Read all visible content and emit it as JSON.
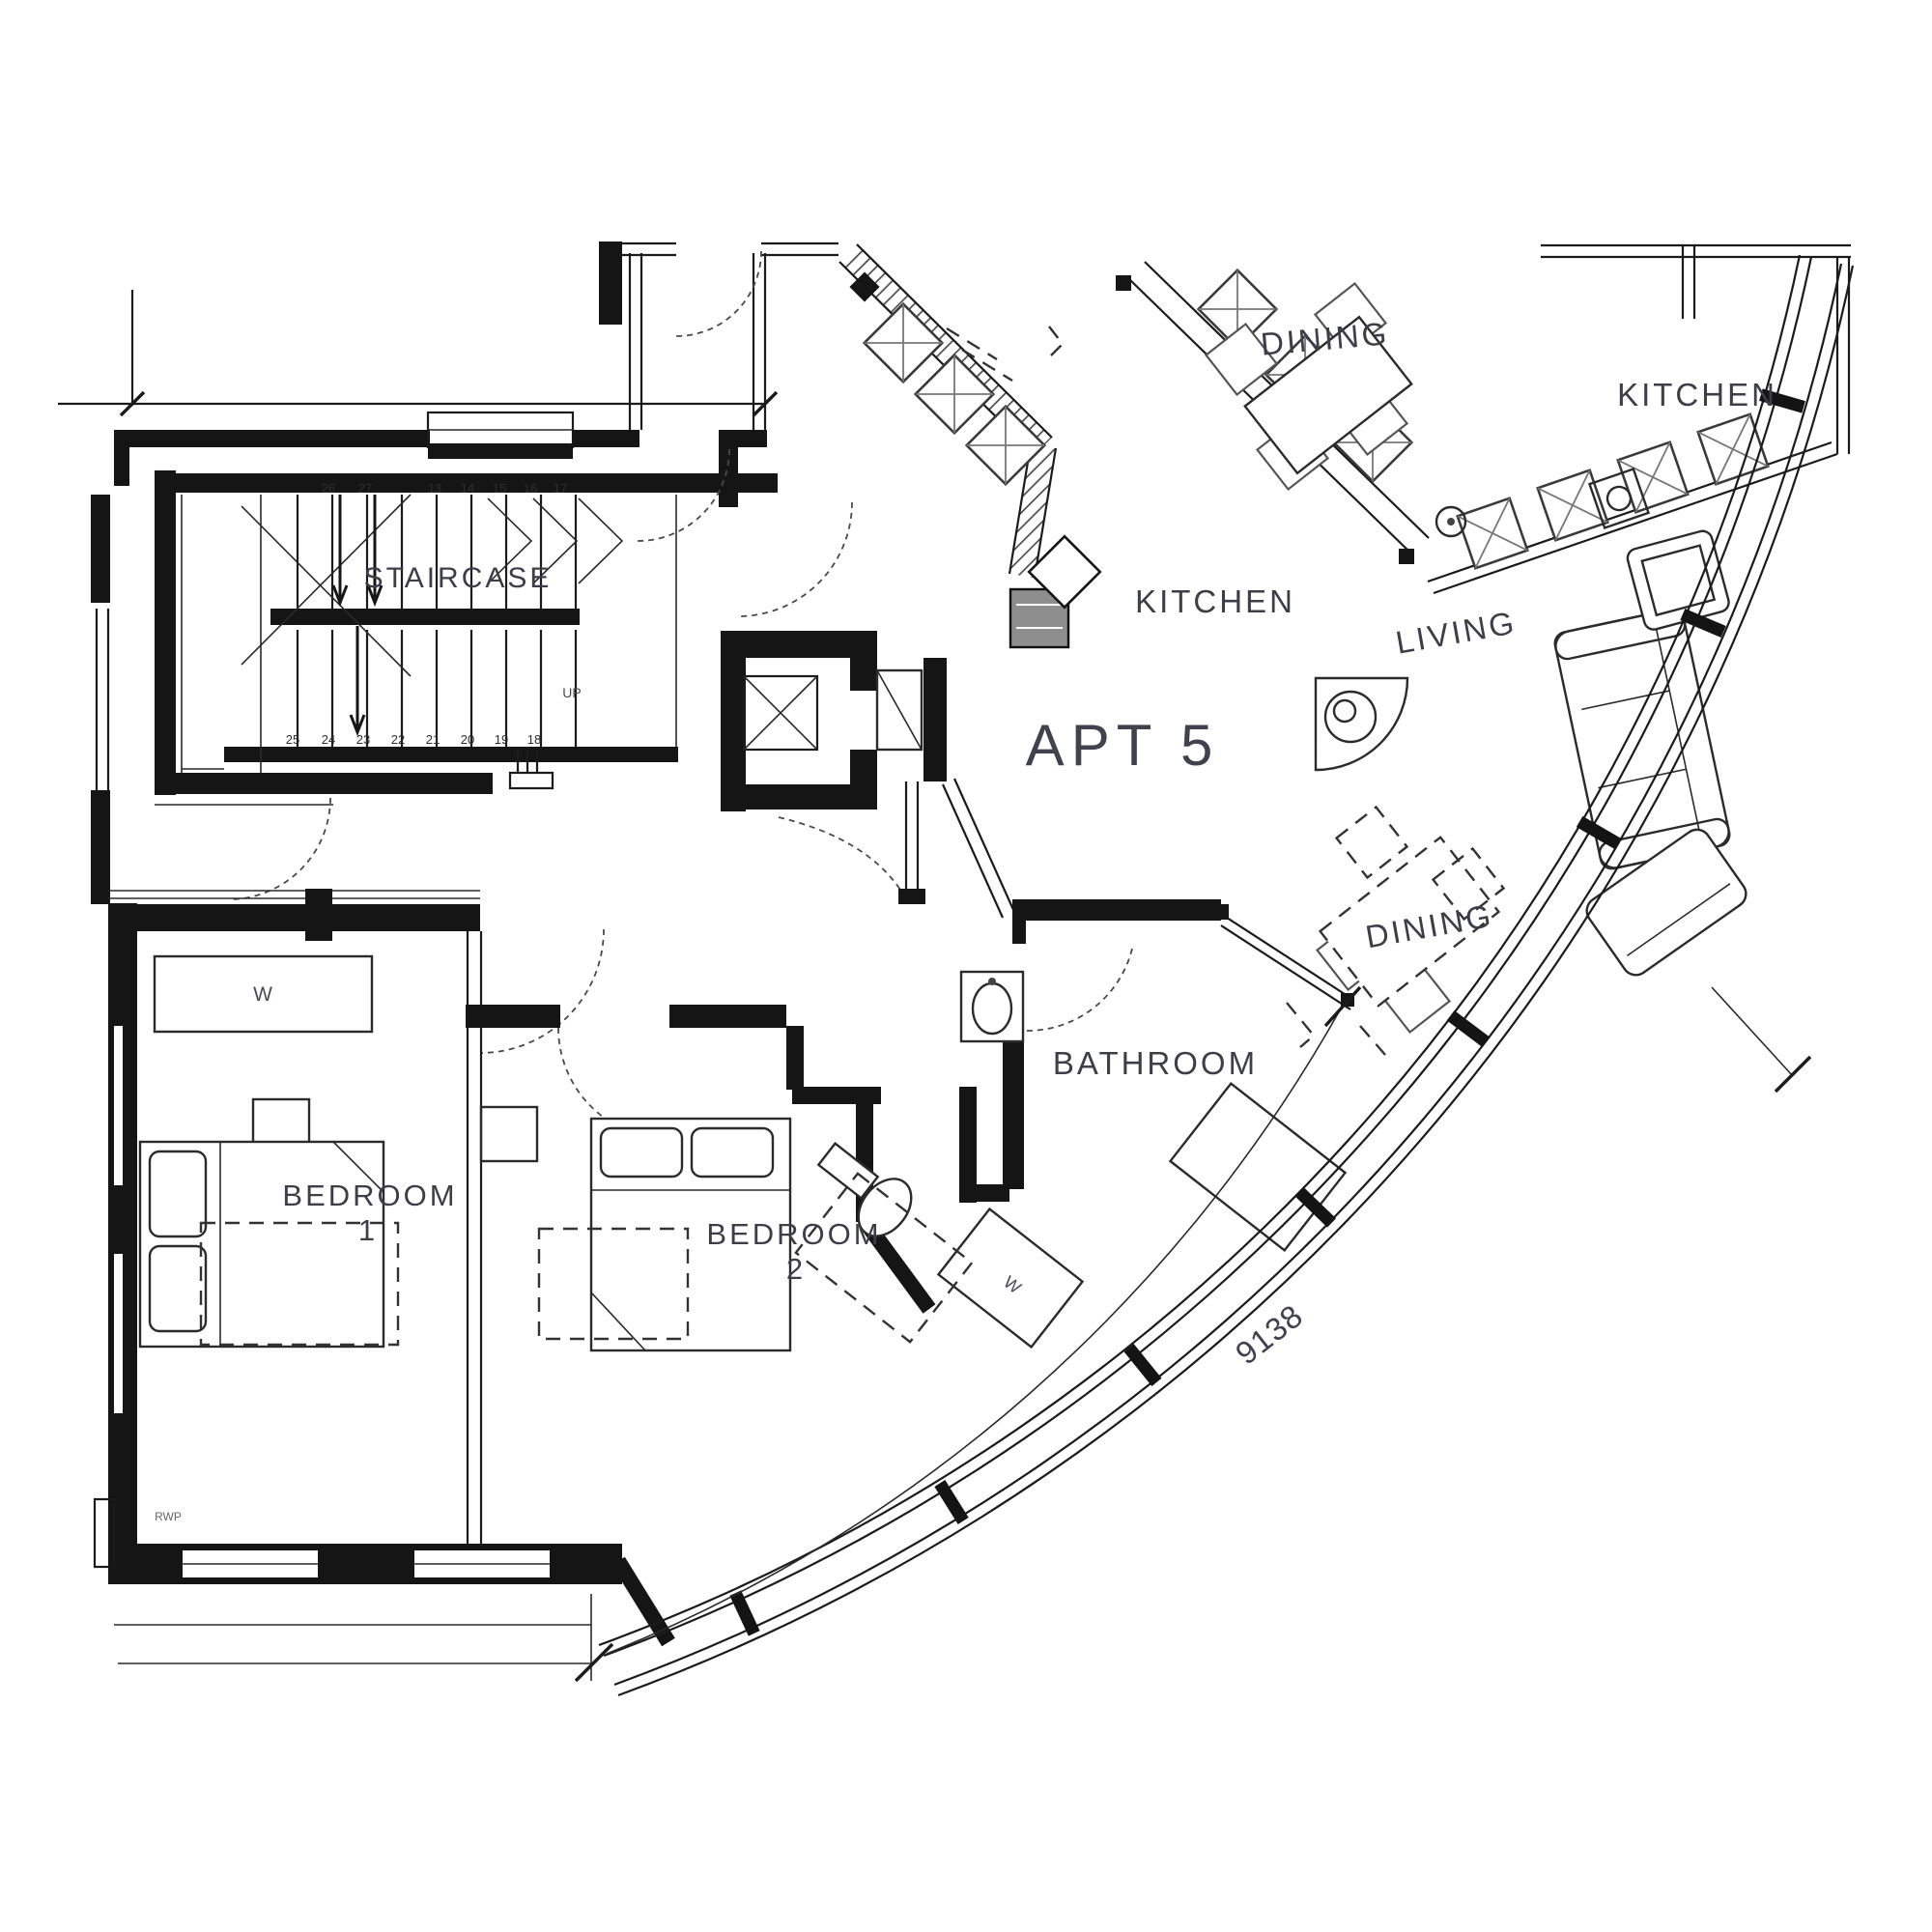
{
  "drawing": {
    "apartment_label": "APT 5",
    "dimension": "9138"
  },
  "rooms": {
    "staircase": "STAIRCASE",
    "dining_top": "DINING",
    "kitchen_top_right": "KITCHEN",
    "kitchen": "KITCHEN",
    "living": "LIVING",
    "dining": "DINING",
    "bathroom": "BATHROOM",
    "bedroom_1": "BEDROOM",
    "bedroom_1_number": "1",
    "bedroom_2": "BEDROOM",
    "bedroom_2_number": "2"
  },
  "annotations": {
    "up": "UP",
    "rwp": "RWP",
    "wardrobe_1": "W",
    "wardrobe_2": "W"
  },
  "stairs": {
    "top_numbers": [
      "26",
      "27",
      "13",
      "14",
      "15",
      "16",
      "17"
    ],
    "bottom_numbers": [
      "25",
      "24",
      "23",
      "22",
      "21",
      "20",
      "19",
      "18"
    ]
  },
  "colors": {
    "ink": "#1b1b1b",
    "label": "#3e3e49"
  }
}
